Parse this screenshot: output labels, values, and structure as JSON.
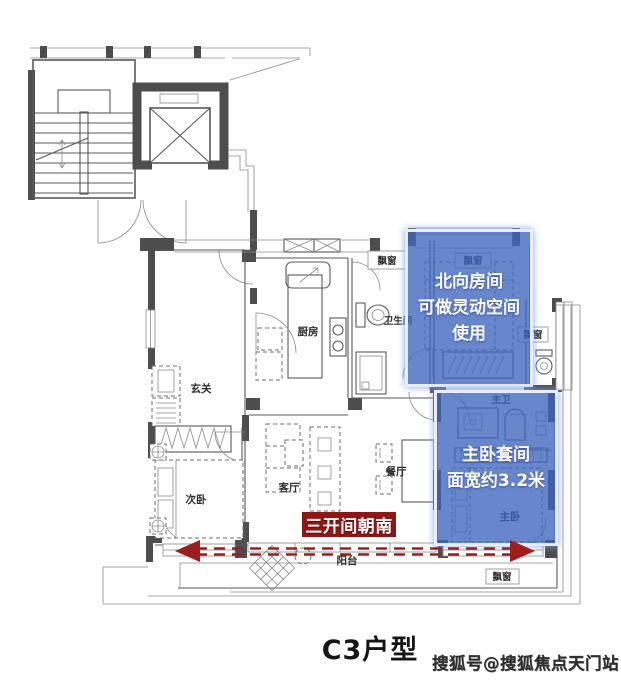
{
  "title": "C3户型",
  "watermark": "搜狐号@搜狐焦点天门站",
  "annotations": {
    "north_room": {
      "lines": [
        "北向房间",
        "可做灵动空间",
        "使用"
      ]
    },
    "master_suite": {
      "lines": [
        "主卧套间",
        "面宽约3.2米"
      ]
    },
    "banner": "三开间朝南"
  },
  "rooms": {
    "entry": "玄关",
    "kitchen": "厨房",
    "bathroom": "卫生间",
    "second_bedroom": "次卧",
    "living_room": "客厅",
    "dining_room": "餐厅",
    "balcony": "阳台",
    "master_bedroom": "主卧",
    "master_bathroom": "主卫",
    "bay_window": "飘窗"
  },
  "colors": {
    "overlay_blue": "#3e64be",
    "banner_red": "#8e1614",
    "arrow_red": "#9e1d1d",
    "wall_dark": "#4d4d4d",
    "line_gray": "#5a5a5a"
  }
}
